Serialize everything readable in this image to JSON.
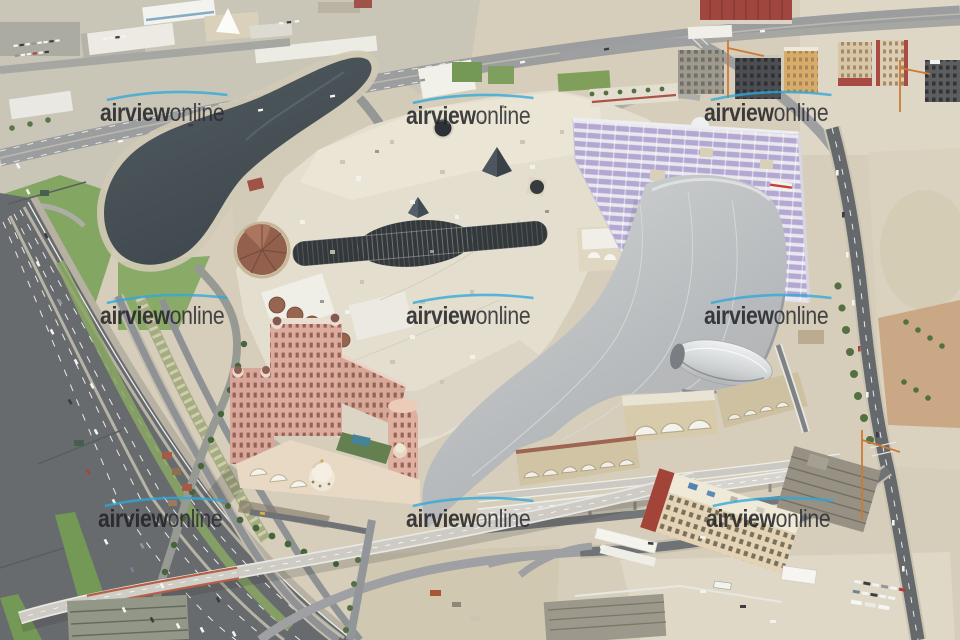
{
  "watermark": {
    "text_bold": "airview",
    "text_light": "online",
    "occurrences": 9,
    "swoosh_color": "#2fa9d9",
    "text_color": "#222226"
  },
  "palette": {
    "sand": "#d5ccb9",
    "asphalt_highway": "#626568",
    "lake_water": "#414a50",
    "mall_roof_cream": "#e3ddcc",
    "ski_slope_gray": "#b9bcbe",
    "ski_dome_silver": "#e0e3e4",
    "parking_canopy_purple": "#b1a5d1",
    "hotel_pink": "#d8a396",
    "grass_green": "#7aa057",
    "flyover_concrete": "#cbc9c2",
    "barrier_red": "#b5593f",
    "tiled_cone_brown": "#8f5a46",
    "construction_gray": "#9a9588"
  },
  "landmarks": [
    "teardrop-lake",
    "industrial-district",
    "multi-lane-highway",
    "flyover-ramp",
    "shopping-mall-roof",
    "indoor-ski-slope",
    "hotel-building",
    "covered-parking-roof",
    "construction-sites",
    "desert-lots"
  ]
}
